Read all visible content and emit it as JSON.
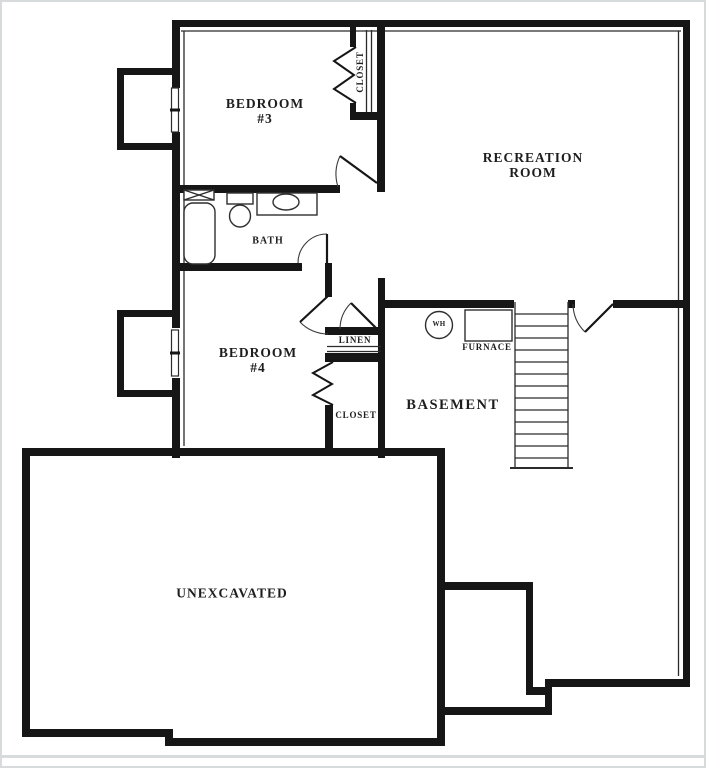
{
  "plan": {
    "labels": {
      "bedroom3_line1": "BEDROOM",
      "bedroom3_line2": "#3",
      "bedroom4_line1": "BEDROOM",
      "bedroom4_line2": "#4",
      "recreation_line1": "RECREATION",
      "recreation_line2": "ROOM",
      "bath": "BATH",
      "closet_bedroom3": "CLOSET",
      "closet_bedroom4": "CLOSET",
      "linen": "LINEN",
      "basement": "BASEMENT",
      "furnace": "FURNACE",
      "water_heater": "WH",
      "unexcavated": "UNEXCAVATED"
    },
    "colors": {
      "wall": "#161616",
      "thin_line": "#2b2b2b",
      "text": "#1d1d1d",
      "background": "#ffffff",
      "frame": "#d8dbdc"
    }
  }
}
